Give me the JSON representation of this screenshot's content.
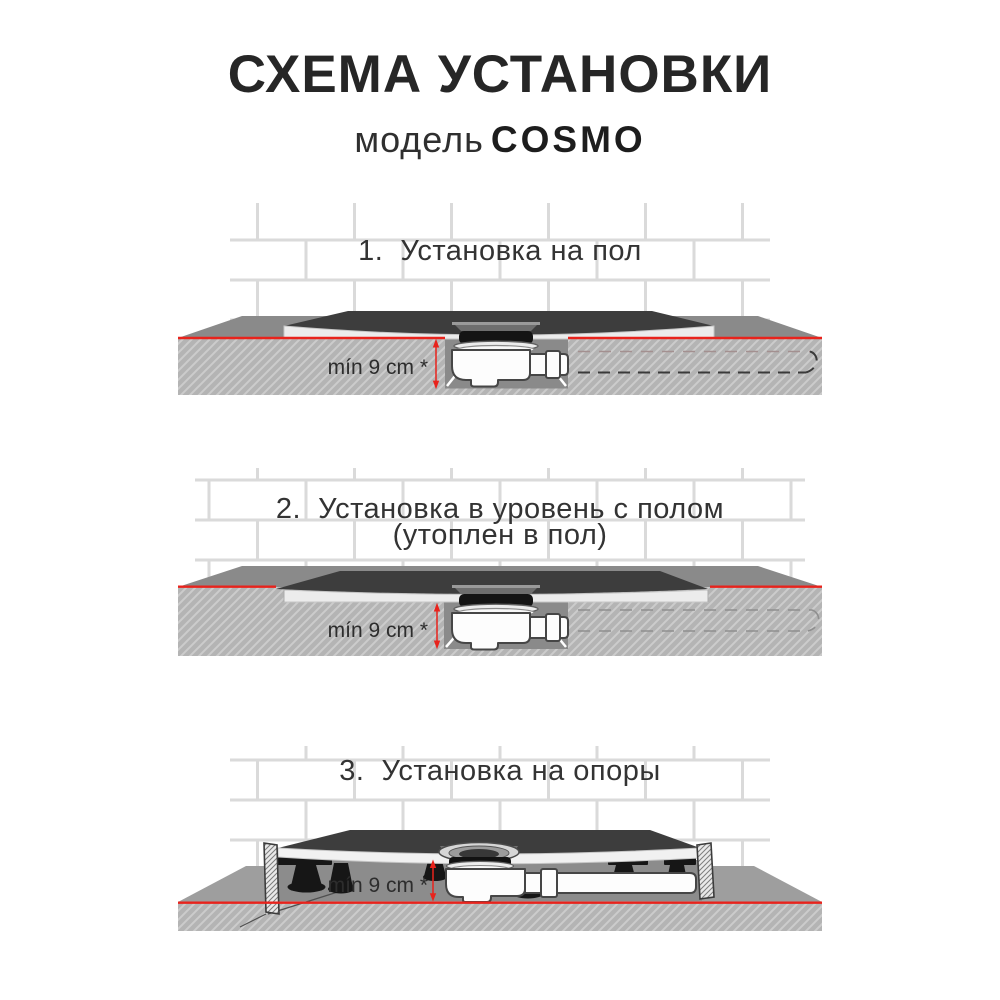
{
  "page": {
    "title": "СХЕМА УСТАНОВКИ",
    "model_label": "модель",
    "model_name": "COSMO"
  },
  "sections": [
    {
      "number": "1.",
      "title": "Установка на пол",
      "dimension_label": "mín 9 cm *"
    },
    {
      "number": "2.",
      "title": "Установка в уровень с полом",
      "title_line2": "(утоплен в пол)",
      "dimension_label": "mín 9 cm *"
    },
    {
      "number": "3.",
      "title": "Установка на опоры",
      "dimension_label": "mín 9 cm *"
    }
  ],
  "colors": {
    "red_accent": "#e8231c",
    "tray_dark": "#3d3d3d",
    "tray_light": "#ececec",
    "floor_top": "#8a8a8a",
    "floor_top_light": "#9e9e9e",
    "floor_face": "#b4b4b4",
    "hatch_line": "#cccccc",
    "shadow": "#8c8c8c",
    "grout": "#dadada",
    "outline": "#464646",
    "text_dark": "#262626",
    "heading": "#333333",
    "dashed": "#3a3a3a",
    "dashed_faded": "#a39090"
  }
}
